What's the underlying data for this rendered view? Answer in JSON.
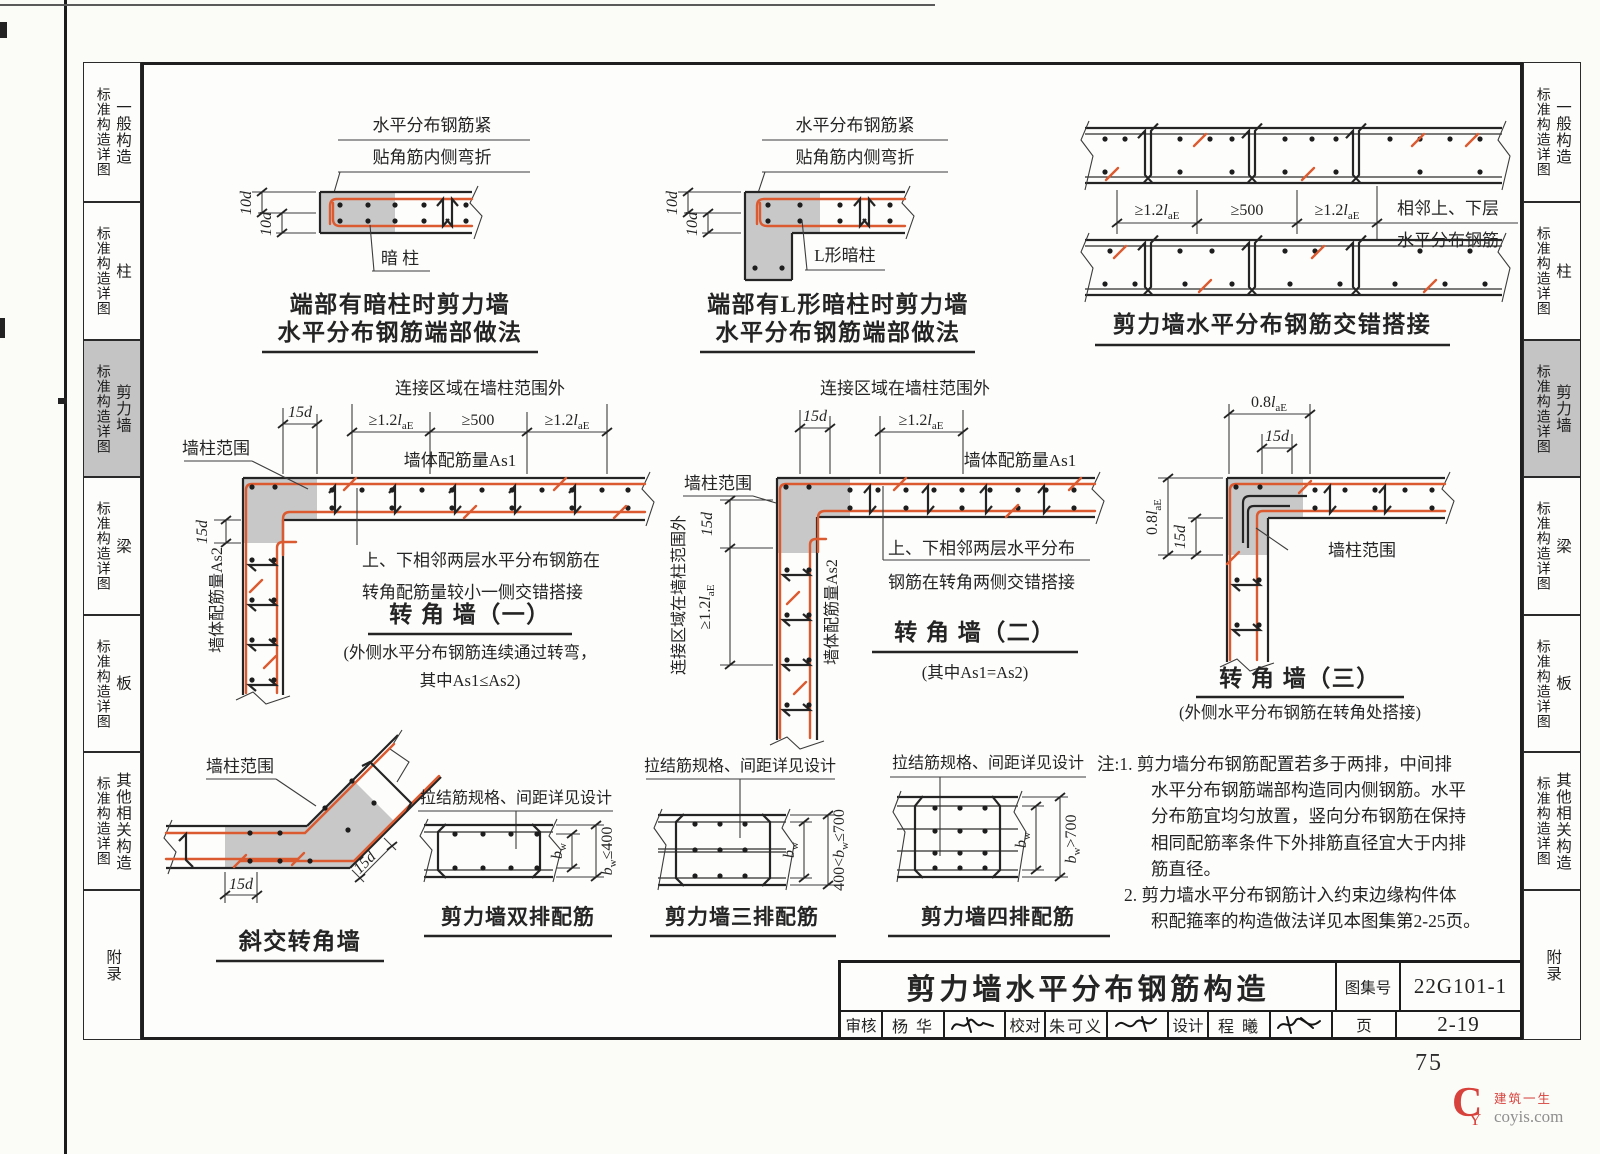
{
  "page": {
    "number": "75"
  },
  "sidebar": {
    "group_label": "标准构造详图",
    "items": [
      {
        "label": "一般构造"
      },
      {
        "label": "柱"
      },
      {
        "label": "剪力墙"
      },
      {
        "label": "梁"
      },
      {
        "label": "板"
      },
      {
        "label": "其他相关构造"
      },
      {
        "label": "附录"
      }
    ],
    "active_index": 2
  },
  "dims": {
    "ge12_pre": "≥1.2",
    "l": "l",
    "ae": "aE",
    "ge500": "≥500",
    "d15": "15d",
    "d10": "10d",
    "p08": "0.8",
    "b": "b",
    "w": "w",
    "le400": "≤400",
    "pre400": "400<",
    "le700": "≤700",
    "gt700": ">700"
  },
  "end_anchor": {
    "callout1": "水平分布钢筋紧",
    "callout2": "贴角筋内侧弯折",
    "part": "暗 柱",
    "title1": "端部有暗柱时剪力墙",
    "title2": "水平分布钢筋端部做法"
  },
  "end_l_anchor": {
    "callout1": "水平分布钢筋紧",
    "callout2": "贴角筋内侧弯折",
    "part": "L形暗柱",
    "title1": "端部有L形暗柱时剪力墙",
    "title2": "水平分布钢筋端部做法"
  },
  "stagger_lap": {
    "note1": "相邻上、下层",
    "note2": "水平分布钢筋",
    "title": "剪力墙水平分布钢筋交错搭接"
  },
  "corner1": {
    "zone_note": "连接区域在墙柱范围外",
    "as1": "墙体配筋量As1",
    "as2": "墙体配筋量As2",
    "range": "墙柱范围",
    "note1": "上、下相邻两层水平分布钢筋在",
    "note2": "转角配筋量较小一侧交错搭接",
    "title": "转 角 墙（一）",
    "sub1": "(外侧水平分布钢筋连续通过转弯，",
    "sub2": "其中As1≤As2)"
  },
  "corner2": {
    "zone_note": "连接区域在墙柱范围外",
    "zone_note_side": "连接区域在墙柱范围外",
    "as1": "墙体配筋量As1",
    "as2": "墙体配筋量As2",
    "range": "墙柱范围",
    "note1": "上、下相邻两层水平分布",
    "note2": "钢筋在转角两侧交错搭接",
    "title": "转 角 墙（二）",
    "sub": "(其中As1=As2)"
  },
  "corner3": {
    "range": "墙柱范围",
    "title": "转 角 墙（三）",
    "sub": "(外侧水平分布钢筋在转角处搭接)"
  },
  "skew_corner": {
    "range": "墙柱范围",
    "title": "斜交转角墙"
  },
  "rows2": {
    "tie_note": "拉结筋规格、间距详见设计",
    "title": "剪力墙双排配筋"
  },
  "rows3": {
    "tie_note": "拉结筋规格、间距详见设计",
    "title": "剪力墙三排配筋"
  },
  "rows4": {
    "tie_note": "拉结筋规格、间距详见设计",
    "title": "剪力墙四排配筋"
  },
  "notes": {
    "head1": "注:1.",
    "n1_l1": "剪力墙分布钢筋配置若多于两排，中间排",
    "n1_l2": "水平分布钢筋端部构造同内侧钢筋。水平",
    "n1_l3": "分布筋宜均匀放置，竖向分布钢筋在保持",
    "n1_l4": "相同配筋率条件下外排筋直径宜大于内排",
    "n1_l5": "筋直径。",
    "head2": "2.",
    "n2_l1": "剪力墙水平分布钢筋计入约束边缘构件体",
    "n2_l2": "积配箍率的构造做法详见本图集第2-25页。"
  },
  "title_block": {
    "title": "剪力墙水平分布钢筋构造",
    "atlas_label": "图集号",
    "atlas_no": "22G101-1",
    "page_label": "页",
    "page_no": "2-19",
    "review_label": "审核",
    "reviewer": "杨 华",
    "check_label": "校对",
    "checker": "朱可义",
    "design_label": "设计",
    "designer": "程 曦"
  },
  "watermark": {
    "logo_c": "C",
    "logo_y": "Y",
    "brand": "建筑一生",
    "site": "coyis.com"
  },
  "colors": {
    "rebar": "#dc5a30",
    "concrete": "#c8c8c8",
    "ink": "#242424",
    "active_tab": "#c4c4c4",
    "watermark_red": "#d8423c"
  }
}
